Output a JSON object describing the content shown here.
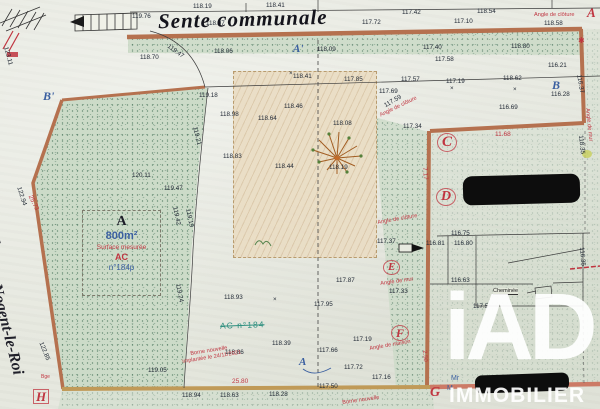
{
  "streets": {
    "top": "Sente communale",
    "left_prefix": "de",
    "left_name": "Nogent-le-Roi"
  },
  "parcel_box": {
    "letter": "A",
    "area": "800m²",
    "surface_label": "Surface mesurée",
    "section": "AC",
    "number": "n°184p"
  },
  "struck_label": "AC n°184",
  "cheminee_label": "Cheminée",
  "logo": {
    "brand": "iAD",
    "subtitle": "IMMOBILIER"
  },
  "colors": {
    "fence_pink": "#b5714f",
    "boundary_ochre": "#c09a58",
    "boundary_salmon": "#cc7a66",
    "annotation_red": "#c03540",
    "label_blue": "#3a5fa0",
    "struck_teal": "#2e8f7f",
    "paper": "#e6e8df",
    "grass": "#ccdbc8",
    "logo_white": "#ffffff",
    "redaction_black": "#0d0d0d"
  },
  "elevations": [
    {
      "t": "119.76",
      "x": 132,
      "y": 13
    },
    {
      "t": "118.19",
      "x": 193,
      "y": 3
    },
    {
      "t": "118.41",
      "x": 266,
      "y": 2
    },
    {
      "t": "118.07",
      "x": 206,
      "y": 20
    },
    {
      "t": "117.42",
      "x": 402,
      "y": 9
    },
    {
      "t": "118.54",
      "x": 477,
      "y": 8
    },
    {
      "t": "117.72",
      "x": 362,
      "y": 19
    },
    {
      "t": "117.10",
      "x": 454,
      "y": 18
    },
    {
      "t": "118.58",
      "x": 544,
      "y": 20
    },
    {
      "t": "118.70",
      "x": 140,
      "y": 54
    },
    {
      "t": "119.47",
      "x": 170,
      "y": 43,
      "r": 36
    },
    {
      "t": "118.06",
      "x": 214,
      "y": 48
    },
    {
      "t": "118.09",
      "x": 317,
      "y": 46
    },
    {
      "t": "117.40",
      "x": 423,
      "y": 44
    },
    {
      "t": "118.80",
      "x": 511,
      "y": 43
    },
    {
      "t": "117.58",
      "x": 435,
      "y": 56
    },
    {
      "t": "116.21",
      "x": 548,
      "y": 62
    },
    {
      "t": "119.18",
      "x": 199,
      "y": 92
    },
    {
      "t": "117.85",
      "x": 344,
      "y": 76
    },
    {
      "t": "117.57",
      "x": 401,
      "y": 76
    },
    {
      "t": "117.19",
      "x": 446,
      "y": 78
    },
    {
      "t": "118.62",
      "x": 503,
      "y": 75
    },
    {
      "t": "117.69",
      "x": 379,
      "y": 88
    },
    {
      "t": "116.69",
      "x": 499,
      "y": 104
    },
    {
      "t": "117.34",
      "x": 403,
      "y": 123
    },
    {
      "t": "116.28",
      "x": 551,
      "y": 91
    },
    {
      "t": "118.41",
      "x": 293,
      "y": 73
    },
    {
      "t": "118.98",
      "x": 220,
      "y": 111
    },
    {
      "t": "118.46",
      "x": 284,
      "y": 103
    },
    {
      "t": "118.64",
      "x": 258,
      "y": 115
    },
    {
      "t": "118.08",
      "x": 333,
      "y": 120
    },
    {
      "t": "118.83",
      "x": 223,
      "y": 153
    },
    {
      "t": "118.44",
      "x": 275,
      "y": 163
    },
    {
      "t": "118.19",
      "x": 329,
      "y": 164
    },
    {
      "t": "117.59",
      "x": 383,
      "y": 103,
      "r": -30
    },
    {
      "t": "120.11",
      "x": 132,
      "y": 172
    },
    {
      "t": "119.47",
      "x": 164,
      "y": 185
    },
    {
      "t": "123.11",
      "x": 9,
      "y": 46,
      "r": 75
    },
    {
      "t": "122.94",
      "x": 22,
      "y": 186,
      "r": 72
    },
    {
      "t": "122.85",
      "x": 44,
      "y": 341,
      "r": 68
    },
    {
      "t": "119.21",
      "x": 198,
      "y": 126,
      "r": 76
    },
    {
      "t": "119.42",
      "x": 178,
      "y": 206,
      "r": 78
    },
    {
      "t": "119.19",
      "x": 191,
      "y": 208,
      "r": 78
    },
    {
      "t": "119.24",
      "x": 181,
      "y": 283,
      "r": 79
    },
    {
      "t": "116.37",
      "x": 582,
      "y": 74,
      "r": 80
    },
    {
      "t": "118.35",
      "x": 584,
      "y": 135,
      "r": 84
    },
    {
      "t": "116.35",
      "x": 585,
      "y": 247,
      "r": 85
    },
    {
      "t": "118.93",
      "x": 224,
      "y": 294
    },
    {
      "t": "117.87",
      "x": 336,
      "y": 277
    },
    {
      "t": "117.95",
      "x": 314,
      "y": 301
    },
    {
      "t": "117.33",
      "x": 389,
      "y": 288
    },
    {
      "t": "118.39",
      "x": 272,
      "y": 340
    },
    {
      "t": "117.66",
      "x": 319,
      "y": 347
    },
    {
      "t": "117.19",
      "x": 353,
      "y": 336
    },
    {
      "t": "118.86",
      "x": 225,
      "y": 349
    },
    {
      "t": "117.72",
      "x": 344,
      "y": 364
    },
    {
      "t": "117.16",
      "x": 372,
      "y": 374
    },
    {
      "t": "117.50",
      "x": 319,
      "y": 383
    },
    {
      "t": "118.94",
      "x": 182,
      "y": 392
    },
    {
      "t": "118.63",
      "x": 220,
      "y": 392
    },
    {
      "t": "118.28",
      "x": 269,
      "y": 391
    },
    {
      "t": "119.05",
      "x": 148,
      "y": 367
    },
    {
      "t": "116.75",
      "x": 451,
      "y": 230
    },
    {
      "t": "116.80",
      "x": 454,
      "y": 240
    },
    {
      "t": "116.81",
      "x": 426,
      "y": 240
    },
    {
      "t": "117.37",
      "x": 377,
      "y": 238
    },
    {
      "t": "116.63",
      "x": 451,
      "y": 277
    },
    {
      "t": "117.5",
      "x": 473,
      "y": 303
    },
    {
      "t": "×",
      "x": 289,
      "y": 70
    },
    {
      "t": "×",
      "x": 450,
      "y": 85
    },
    {
      "t": "×",
      "x": 273,
      "y": 296
    },
    {
      "t": "×",
      "x": 513,
      "y": 86
    }
  ],
  "red_annotations": [
    {
      "t": "Angle de clôture",
      "x": 534,
      "y": 12
    },
    {
      "t": "Angle de clôture",
      "x": 379,
      "y": 113,
      "r": -26
    },
    {
      "t": "Angle de clôture",
      "x": 377,
      "y": 220,
      "r": -10
    },
    {
      "t": "Angle de mur",
      "x": 380,
      "y": 281,
      "r": -8
    },
    {
      "t": "Angle de maison",
      "x": 369,
      "y": 346,
      "r": -10
    },
    {
      "t": "Angle de mur",
      "x": 590,
      "y": 108,
      "r": 84
    },
    {
      "t": "11.68",
      "x": 495,
      "y": 131,
      "s": 6.5
    },
    {
      "t": "7.17",
      "x": 428,
      "y": 167,
      "r": 85,
      "s": 6.5
    },
    {
      "t": "25.80",
      "x": 232,
      "y": 378,
      "s": 6.5
    },
    {
      "t": "25.73",
      "x": 33,
      "y": 194,
      "r": 64,
      "s": 6.5
    },
    {
      "t": "2.50",
      "x": 427,
      "y": 350,
      "r": 85,
      "s": 6
    },
    {
      "t": "Borne nouvelle",
      "x": 190,
      "y": 351,
      "r": -9
    },
    {
      "t": "implantée le 24/11/2021",
      "x": 182,
      "y": 359,
      "r": -9
    },
    {
      "t": "Borne nouvelle",
      "x": 342,
      "y": 400,
      "r": -8
    },
    {
      "t": "Bge",
      "x": 41,
      "y": 374,
      "s": 5
    },
    {
      "t": "✱",
      "x": 578,
      "y": 36,
      "s": 8
    }
  ],
  "point_letters": [
    {
      "t": "B'",
      "x": 43,
      "y": 90,
      "c": "#3a5fa0",
      "s": 12
    },
    {
      "t": "A'",
      "x": 293,
      "y": 44,
      "c": "#3a5fa0",
      "s": 11
    },
    {
      "t": "B",
      "x": 552,
      "y": 79,
      "c": "#3a5fa0",
      "s": 12
    },
    {
      "t": "A",
      "x": 299,
      "y": 357,
      "c": "#3a5fa0",
      "s": 11
    },
    {
      "t": "C",
      "x": 437,
      "y": 133,
      "c": "#c03540",
      "s": 15,
      "cls": "circ"
    },
    {
      "t": "D",
      "x": 436,
      "y": 188,
      "c": "#c03540",
      "s": 14,
      "cls": "circ"
    },
    {
      "t": "E",
      "x": 383,
      "y": 260,
      "c": "#c03540",
      "s": 11,
      "cls": "circ"
    },
    {
      "t": "F",
      "x": 391,
      "y": 325,
      "c": "#c03540",
      "s": 12,
      "cls": "circ"
    },
    {
      "t": "G",
      "x": 430,
      "y": 386,
      "c": "#c03540",
      "s": 14
    },
    {
      "t": "H",
      "x": 33,
      "y": 389,
      "c": "#c03540",
      "s": 13,
      "cls": "boxed"
    },
    {
      "t": "A",
      "x": 587,
      "y": 6,
      "c": "#c03540",
      "s": 13
    }
  ],
  "blue_notes": [
    {
      "t": "Mr",
      "x": 451,
      "y": 375
    },
    {
      "t": "M",
      "x": 447,
      "y": 385
    }
  ]
}
